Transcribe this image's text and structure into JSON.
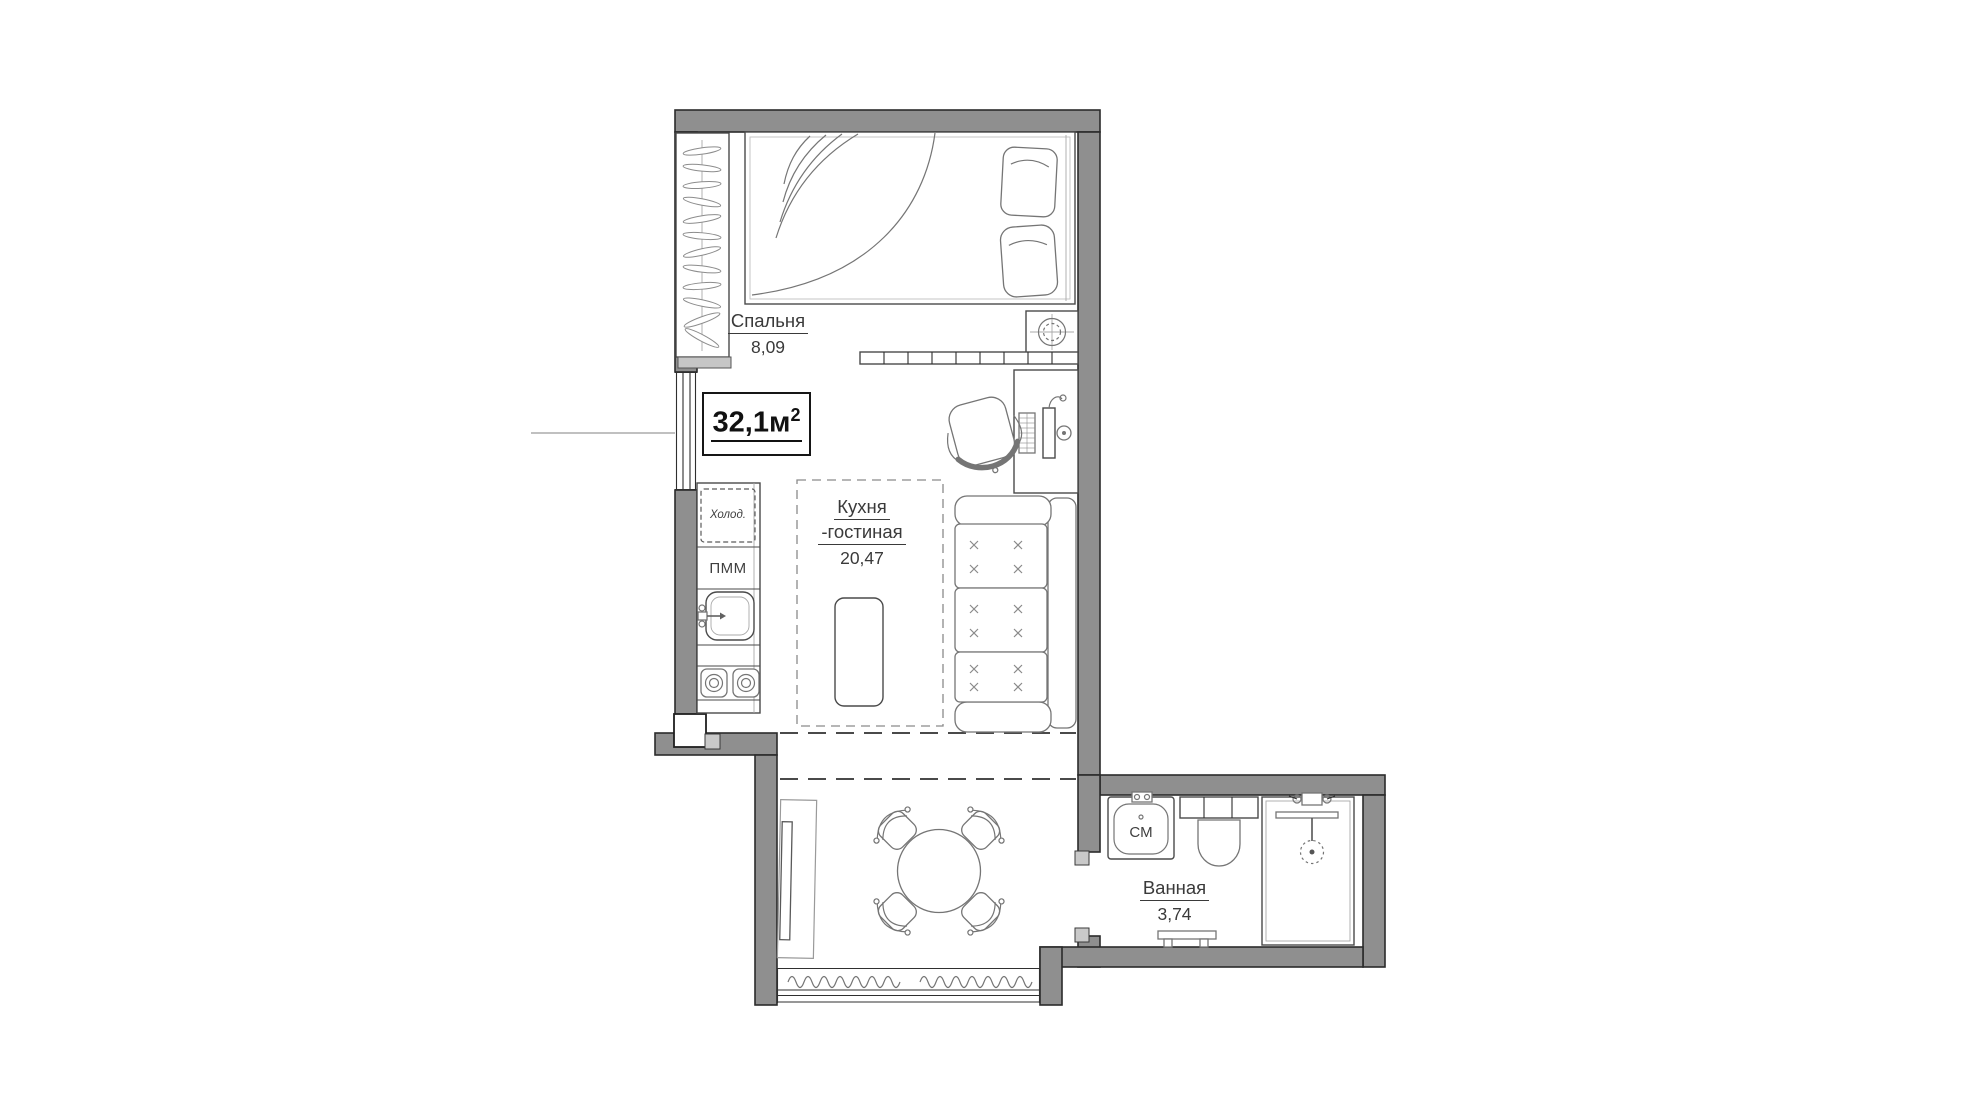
{
  "floor_plan": {
    "total_area": {
      "value": "32,1м",
      "sup": "2"
    },
    "rooms": [
      {
        "name": "Спальня",
        "area": "8,09"
      },
      {
        "name": "Кухня",
        "name2": "-гостиная",
        "area": "20,47"
      },
      {
        "name": "Ванная",
        "area": "3,74"
      }
    ],
    "appliances": {
      "fridge": "Холод.",
      "dishwasher": "ПММ",
      "washer": "СМ"
    },
    "colors": {
      "wall_fill": "#8f8f8f",
      "wall_edge": "#2b2b2b",
      "furniture_line": "#757575",
      "jamb_fill": "#c9c9c9",
      "text": "#3a3a3a"
    }
  }
}
